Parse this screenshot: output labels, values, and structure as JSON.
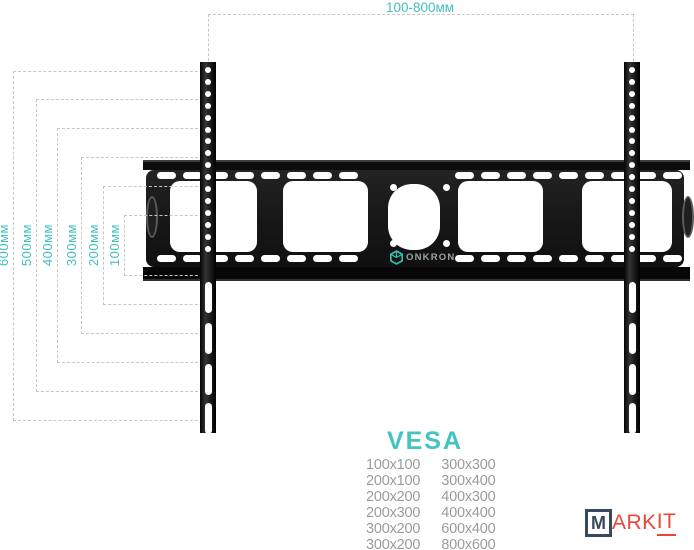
{
  "top_dimension": {
    "label": "100-800мм"
  },
  "left_dimensions": [
    {
      "label": "600мм"
    },
    {
      "label": "500мм"
    },
    {
      "label": "400мм"
    },
    {
      "label": "300мм"
    },
    {
      "label": "200мм"
    },
    {
      "label": "100мм"
    }
  ],
  "brand_plate": {
    "logo_text": "ONKRON",
    "logo_icon": "cube-outline-icon"
  },
  "vesa": {
    "title": "VESA",
    "rows": [
      [
        "100x100",
        "300x300"
      ],
      [
        "200x100",
        "300x400"
      ],
      [
        "200x200",
        "400x300"
      ],
      [
        "200x300",
        "400x400"
      ],
      [
        "300x200",
        "600x400"
      ],
      [
        "300x200",
        "800x600"
      ]
    ]
  },
  "watermark": {
    "boxed_letter": "M",
    "middle": "ARK",
    "underlined": "IT"
  },
  "colors": {
    "teal_accent": "#43bfbf",
    "dashed_line": "#c7c7c7",
    "mount_black": "#161616",
    "table_text": "#9c9c9c",
    "onkron_icon_teal": "#35c2b4",
    "onkron_text_gray": "#9aa3a6",
    "markit_red": "#e8473b",
    "markit_navy": "#37495c"
  }
}
